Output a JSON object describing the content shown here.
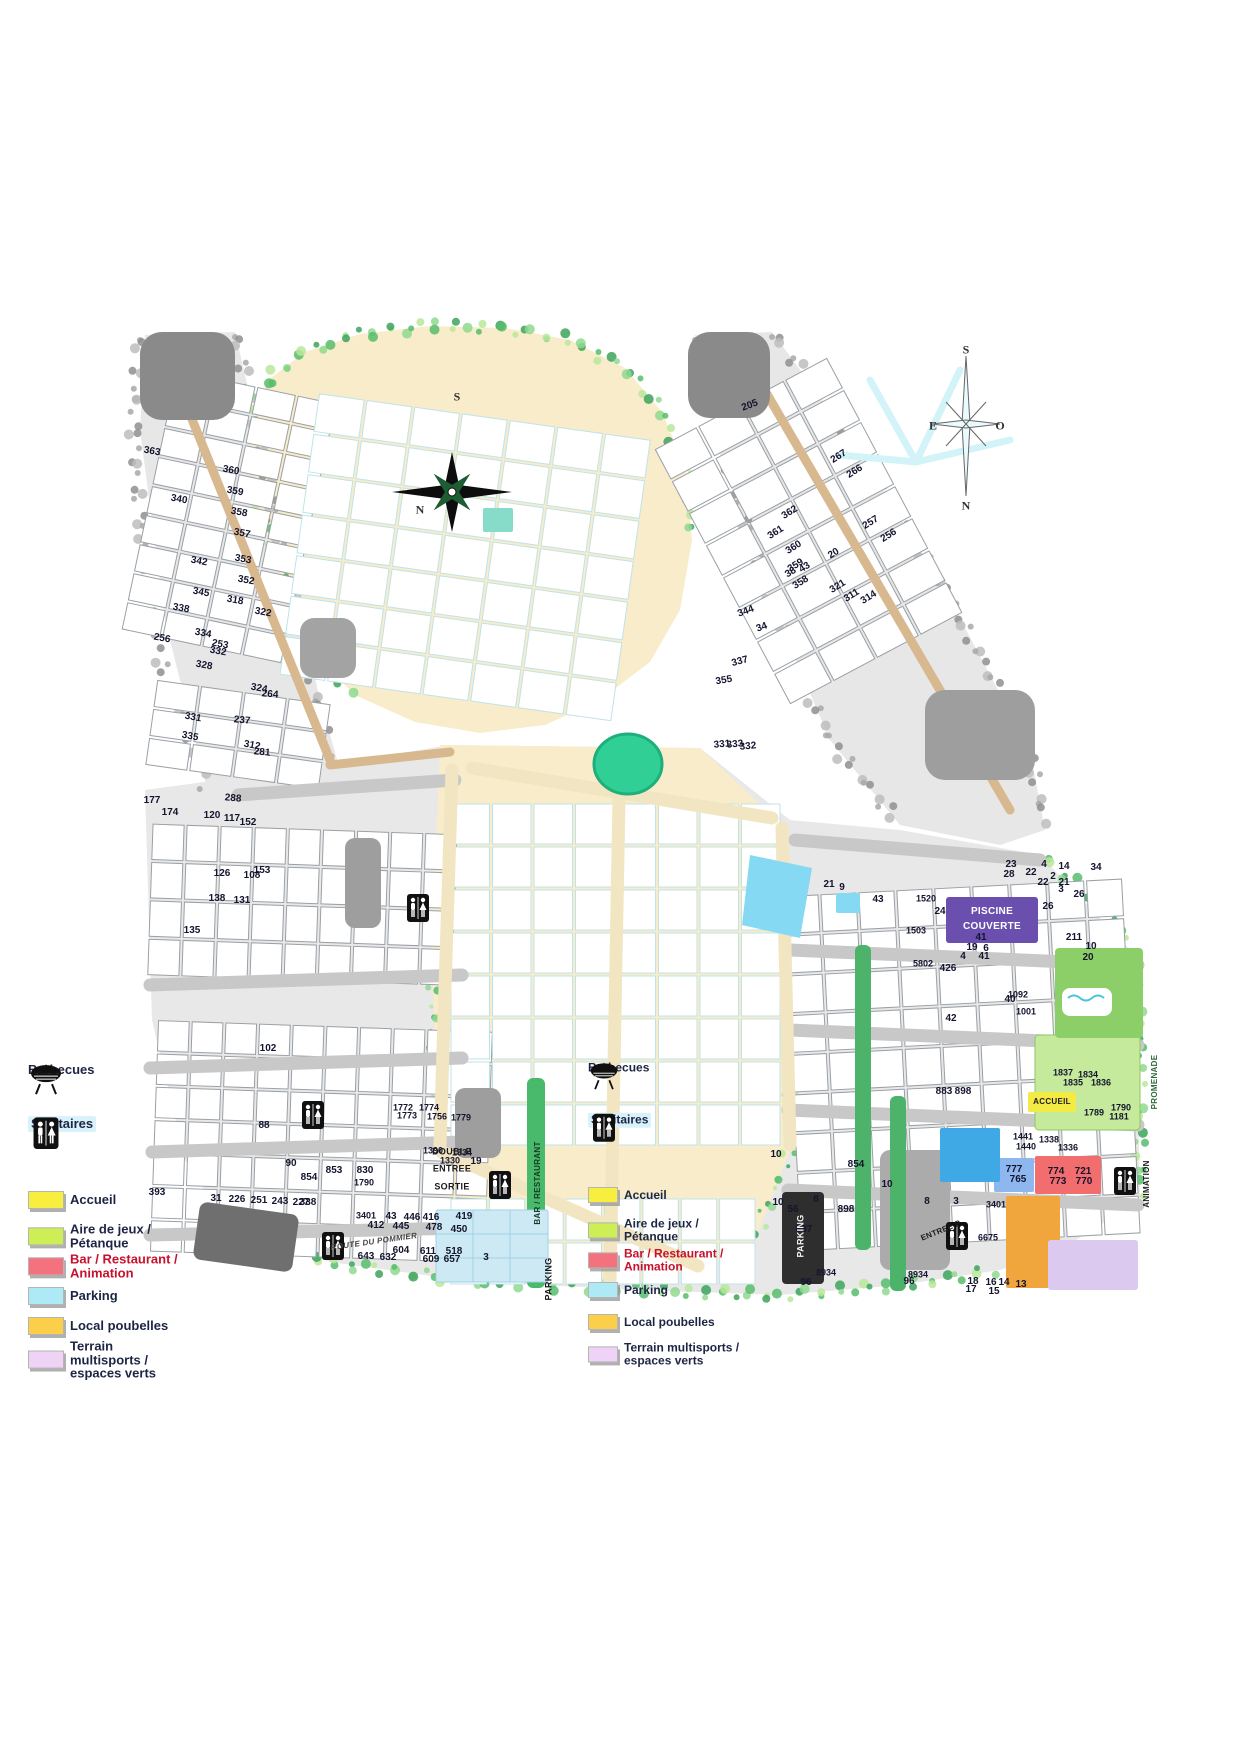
{
  "legend": {
    "items": [
      {
        "id": "barbecues",
        "label": "Barbecues",
        "kind": "icon",
        "icon": "barbecue"
      },
      {
        "id": "sanitaires",
        "label": "Sanitaires",
        "kind": "icon",
        "icon": "sanitaires",
        "highlight": "#d9f1fb"
      },
      {
        "id": "accueil",
        "label": "Accueil",
        "kind": "swatch",
        "color": "#f7ee3d"
      },
      {
        "id": "aire-de-jeux",
        "label": "Aire de jeux / Pétanque",
        "kind": "swatch",
        "color": "#cdee55"
      },
      {
        "id": "bar-restaurant",
        "label": "Bar / Restaurant / Animation",
        "kind": "swatch",
        "color": "#f4717e",
        "text_color": "#c8102e"
      },
      {
        "id": "parking",
        "label": "Parking",
        "kind": "swatch",
        "color": "#aeeaf6"
      },
      {
        "id": "local-poubelles",
        "label": "Local poubelles",
        "kind": "swatch",
        "color": "#fccf4a"
      },
      {
        "id": "terrain-multisports",
        "label": "Terrain multisports / espaces verts",
        "kind": "swatch",
        "color": "#efd3f6"
      }
    ]
  },
  "compasses": {
    "main_letters": [
      {
        "t": "S",
        "x": 457,
        "y": 397
      },
      {
        "t": "N",
        "x": 420,
        "y": 510
      }
    ],
    "secondary_letters": [
      {
        "t": "S",
        "x": 966,
        "y": 350
      },
      {
        "t": "E",
        "x": 933,
        "y": 426
      },
      {
        "t": "O",
        "x": 1000,
        "y": 426
      },
      {
        "t": "N",
        "x": 966,
        "y": 506
      }
    ]
  },
  "map": {
    "area_labels": [
      {
        "text": "BAR / RESTAURANT",
        "x": 538,
        "y": 1183,
        "r": -90,
        "s": 8,
        "c": "#173a20"
      },
      {
        "text": "PARKING",
        "x": 549,
        "y": 1279,
        "r": -90,
        "s": 9
      },
      {
        "text": "PARKING",
        "x": 801,
        "y": 1236,
        "r": -90,
        "s": 9,
        "c": "#f2f2f2"
      },
      {
        "text": "DOUBLE",
        "x": 452,
        "y": 1152,
        "s": 9
      },
      {
        "text": "ENTREE",
        "x": 452,
        "y": 1169,
        "s": 9
      },
      {
        "text": "SORTIE",
        "x": 452,
        "y": 1187,
        "s": 9
      },
      {
        "text": "PISCINE",
        "x": 992,
        "y": 912,
        "s": 10,
        "c": "#ffffff"
      },
      {
        "text": "COUVERTE",
        "x": 992,
        "y": 927,
        "s": 10,
        "c": "#ffffff"
      },
      {
        "text": "ACCUEIL",
        "x": 1052,
        "y": 1102,
        "s": 8
      },
      {
        "text": "ANIMATION",
        "x": 1147,
        "y": 1184,
        "r": -90,
        "s": 8
      },
      {
        "text": "PROMENADE",
        "x": 1155,
        "y": 1082,
        "r": -90,
        "s": 8,
        "c": "#2f6b3c"
      },
      {
        "text": "ENTREE P",
        "x": 941,
        "y": 1231,
        "r": -22,
        "s": 8
      },
      {
        "text": "ROUTE DU POMMIER",
        "x": 374,
        "y": 1242,
        "r": -8,
        "s": 8,
        "i": true
      }
    ],
    "sanitaires_positions": [
      [
        500,
        1185
      ],
      [
        333,
        1246
      ],
      [
        957,
        1236
      ],
      [
        1125,
        1181
      ],
      [
        418,
        908
      ],
      [
        313,
        1115
      ]
    ],
    "plot_numbers": [
      [
        363,
        152,
        452,
        10
      ],
      [
        360,
        231,
        471,
        10
      ],
      [
        359,
        235,
        492,
        10
      ],
      [
        358,
        239,
        513,
        10
      ],
      [
        357,
        242,
        534,
        10
      ],
      [
        340,
        179,
        500,
        10
      ],
      [
        342,
        199,
        562,
        10
      ],
      [
        353,
        243,
        560,
        10
      ],
      [
        352,
        246,
        581,
        10
      ],
      [
        345,
        201,
        593,
        10
      ],
      [
        338,
        181,
        609,
        10
      ],
      [
        334,
        203,
        634,
        10
      ],
      [
        332,
        218,
        652,
        10
      ],
      [
        328,
        204,
        666,
        10
      ],
      [
        322,
        263,
        613,
        10
      ],
      [
        318,
        235,
        601,
        10
      ],
      [
        324,
        259,
        689,
        10
      ],
      [
        312,
        252,
        746,
        10
      ],
      [
        335,
        190,
        737,
        10
      ],
      [
        331,
        193,
        718,
        10
      ],
      [
        288,
        233,
        799,
        5
      ],
      [
        281,
        262,
        753,
        5
      ],
      [
        264,
        270,
        695,
        5
      ],
      [
        256,
        162,
        639,
        10
      ],
      [
        253,
        220,
        645,
        10
      ],
      [
        237,
        242,
        721,
        5
      ],
      [
        177,
        152,
        801
      ],
      [
        174,
        170,
        813
      ],
      [
        120,
        212,
        816
      ],
      [
        117,
        232,
        819
      ],
      [
        152,
        248,
        823
      ],
      [
        153,
        262,
        871
      ],
      [
        126,
        222,
        874
      ],
      [
        108,
        252,
        876
      ],
      [
        131,
        242,
        901
      ],
      [
        138,
        217,
        899
      ],
      [
        135,
        192,
        931
      ],
      [
        102,
        268,
        1049
      ],
      [
        88,
        264,
        1126
      ],
      [
        90,
        291,
        1164
      ],
      [
        393,
        157,
        1193
      ],
      [
        31,
        216,
        1199
      ],
      [
        226,
        237,
        1200
      ],
      [
        251,
        259,
        1201
      ],
      [
        243,
        280,
        1202
      ],
      [
        227,
        301,
        1203
      ],
      [
        1772,
        403,
        1108
      ],
      [
        1774,
        429,
        1108
      ],
      [
        1773,
        407,
        1116
      ],
      [
        1756,
        437,
        1117
      ],
      [
        1779,
        461,
        1118
      ],
      [
        1390,
        433,
        1151
      ],
      [
        1334,
        462,
        1153
      ],
      [
        1330,
        450,
        1161
      ],
      [
        19,
        476,
        1162
      ],
      [
        854,
        309,
        1178
      ],
      [
        853,
        334,
        1171
      ],
      [
        830,
        365,
        1171
      ],
      [
        1790,
        364,
        1183
      ],
      [
        338,
        308,
        1203
      ],
      [
        3401,
        366,
        1216
      ],
      [
        43,
        391,
        1217
      ],
      [
        416,
        431,
        1218
      ],
      [
        446,
        412,
        1218
      ],
      [
        419,
        464,
        1217
      ],
      [
        412,
        376,
        1226
      ],
      [
        445,
        401,
        1227
      ],
      [
        478,
        434,
        1228
      ],
      [
        450,
        459,
        1230
      ],
      [
        604,
        401,
        1251
      ],
      [
        611,
        428,
        1252
      ],
      [
        518,
        454,
        1252
      ],
      [
        643,
        366,
        1257
      ],
      [
        632,
        388,
        1258
      ],
      [
        609,
        431,
        1260
      ],
      [
        657,
        452,
        1260
      ],
      [
        3,
        486,
        1258
      ],
      [
        205,
        750,
        406,
        -20
      ],
      [
        267,
        839,
        457,
        -32
      ],
      [
        266,
        855,
        472,
        -32
      ],
      [
        257,
        871,
        523,
        -32
      ],
      [
        256,
        889,
        536,
        -32
      ],
      [
        362,
        790,
        513,
        -32
      ],
      [
        361,
        776,
        533,
        -32
      ],
      [
        360,
        794,
        548,
        -32
      ],
      [
        359,
        796,
        566,
        -32
      ],
      [
        358,
        801,
        583,
        -32
      ],
      [
        321,
        838,
        587,
        -32
      ],
      [
        311,
        852,
        596,
        -32
      ],
      [
        314,
        869,
        598,
        -32
      ],
      [
        20,
        834,
        554,
        -32
      ],
      [
        38,
        791,
        573,
        -32
      ],
      [
        43,
        805,
        568,
        -32
      ],
      [
        355,
        724,
        681,
        -10
      ],
      [
        344,
        746,
        612,
        -20
      ],
      [
        337,
        740,
        662,
        -15
      ],
      [
        333,
        735,
        745,
        -5
      ],
      [
        332,
        748,
        747,
        -5
      ],
      [
        331,
        722,
        745,
        -5
      ],
      [
        34,
        762,
        628,
        -20
      ],
      [
        1520,
        926,
        899
      ],
      [
        1503,
        916,
        931
      ],
      [
        5802,
        923,
        964
      ],
      [
        426,
        948,
        969
      ],
      [
        42,
        951,
        1019
      ],
      [
        41,
        981,
        938
      ],
      [
        19,
        972,
        948
      ],
      [
        6,
        986,
        949
      ],
      [
        4,
        963,
        957
      ],
      [
        41,
        984,
        957
      ],
      [
        211,
        1074,
        938
      ],
      [
        10,
        1091,
        947
      ],
      [
        26,
        1048,
        907
      ],
      [
        28,
        1009,
        875
      ],
      [
        23,
        1011,
        865
      ],
      [
        22,
        1031,
        873
      ],
      [
        4,
        1044,
        865
      ],
      [
        14,
        1064,
        867
      ],
      [
        2,
        1053,
        877
      ],
      [
        21,
        1064,
        883
      ],
      [
        3,
        1061,
        890
      ],
      [
        34,
        1096,
        868
      ],
      [
        22,
        1043,
        883
      ],
      [
        26,
        1079,
        895
      ],
      [
        21,
        829,
        885
      ],
      [
        9,
        842,
        888
      ],
      [
        43,
        878,
        900
      ],
      [
        24,
        940,
        912
      ],
      [
        20,
        1088,
        958
      ],
      [
        40,
        1010,
        1000
      ],
      [
        1092,
        1018,
        995
      ],
      [
        1001,
        1026,
        1012
      ],
      [
        883,
        944,
        1092
      ],
      [
        898,
        963,
        1092
      ],
      [
        854,
        856,
        1165
      ],
      [
        10,
        776,
        1155
      ],
      [
        10,
        778,
        1203
      ],
      [
        8,
        816,
        1200
      ],
      [
        56,
        793,
        1210
      ],
      [
        898,
        846,
        1210
      ],
      [
        887,
        804,
        1230
      ],
      [
        8934,
        826,
        1273
      ],
      [
        96,
        806,
        1283
      ],
      [
        10,
        887,
        1185
      ],
      [
        8,
        927,
        1202
      ],
      [
        3,
        956,
        1202
      ],
      [
        3401,
        996,
        1205
      ],
      [
        6675,
        988,
        1238
      ],
      [
        8934,
        918,
        1275
      ],
      [
        96,
        909,
        1282
      ],
      [
        18,
        973,
        1282
      ],
      [
        16,
        991,
        1283
      ],
      [
        17,
        971,
        1290
      ],
      [
        15,
        994,
        1292
      ],
      [
        14,
        1004,
        1283
      ],
      [
        13,
        1021,
        1285
      ],
      [
        1837,
        1063,
        1073
      ],
      [
        1834,
        1088,
        1075
      ],
      [
        1836,
        1101,
        1083
      ],
      [
        1835,
        1073,
        1083
      ],
      [
        1790,
        1121,
        1108
      ],
      [
        1789,
        1094,
        1113
      ],
      [
        1181,
        1119,
        1117
      ],
      [
        1441,
        1023,
        1137
      ],
      [
        1440,
        1026,
        1147
      ],
      [
        1338,
        1049,
        1140
      ],
      [
        1336,
        1068,
        1148
      ],
      [
        777,
        1014,
        1170
      ],
      [
        765,
        1018,
        1180
      ],
      [
        774,
        1056,
        1172
      ],
      [
        721,
        1083,
        1172
      ],
      [
        773,
        1058,
        1182
      ],
      [
        770,
        1084,
        1182
      ]
    ]
  },
  "colors": {
    "road_tan": "#d8b88f",
    "plot_cream": "#f8ecca",
    "zone_gray": "#e7e7e7",
    "hedge_green": "#57bd6b",
    "pond_teal": "#2fcf96",
    "piscine_purple": "#6a4fae",
    "accueil_yellow": "#f3ea45",
    "bar_red": "#f26d6d",
    "parking_cyan": "#86d9f2",
    "poubelles_orange": "#f0a63c",
    "multisports_violet": "#dcc9f0"
  }
}
